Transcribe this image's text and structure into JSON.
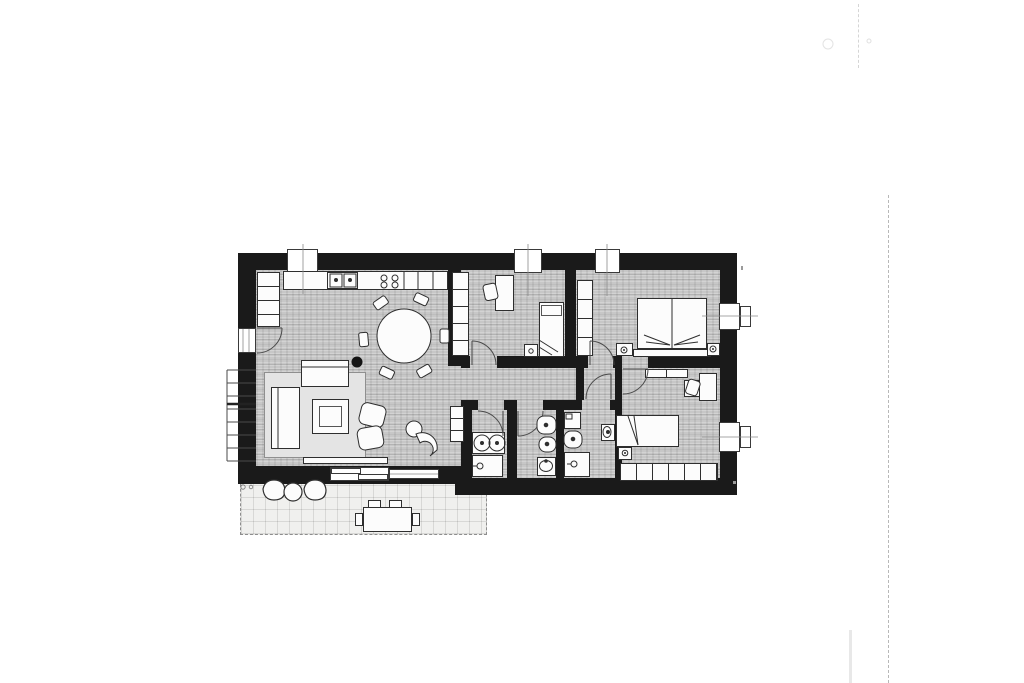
{
  "document": {
    "kind": "scanned-apartment-floor-plan",
    "visible_text": "none",
    "paper_color": "#ffffff"
  },
  "palette": {
    "wall": "#1a1a1a",
    "floor": "#c7c7c7",
    "furniture_fill": "#fcfcfc",
    "line": "#2e2e2e",
    "terrace": "#f0f0ee",
    "rug": "#e4e4e4",
    "scan_artifact": "#b8b8b8"
  },
  "apartment": {
    "rooms": [
      {
        "name": "kitchen-living-room",
        "furniture": [
          "tall-cabinet-column",
          "kitchen-counter",
          "double-sink",
          "cooktop-4-burners",
          "round-dining-table",
          "6-dining-chairs",
          "rug",
          "sofa",
          "corner-sofa",
          "coffee-table",
          "2-armchairs",
          "lounge-chair",
          "side-stool",
          "low-sideboard",
          "column-dot"
        ]
      },
      {
        "name": "bedroom-1",
        "furniture": [
          "wardrobe-5-doors",
          "desk",
          "desk-chair",
          "single-bed",
          "nightstand-with-lamp"
        ]
      },
      {
        "name": "bedroom-2",
        "furniture": [
          "wardrobe-4-doors",
          "double-bed",
          "headboard",
          "nightstand-left-with-lamp",
          "nightstand-right-with-lamp"
        ]
      },
      {
        "name": "bedroom-3",
        "furniture": [
          "wall-shelf",
          "cabinet",
          "desk",
          "desk-chair",
          "single-bed",
          "nightstand-with-lamp",
          "wardrobe-6-doors"
        ]
      },
      {
        "name": "bathroom-1",
        "furniture": [
          "double-washbasin-vanity",
          "shower"
        ]
      },
      {
        "name": "bathroom-2",
        "furniture": [
          "toilet",
          "bidet",
          "washbasin"
        ]
      },
      {
        "name": "bathroom-3",
        "furniture": [
          "washing-machine",
          "toilet",
          "shower",
          "washbasin"
        ]
      },
      {
        "name": "hallway",
        "furniture": [
          "shelf-unit"
        ]
      },
      {
        "name": "terrace",
        "furniture": [
          "2-lounge-chairs",
          "round-side-table",
          "outdoor-dining-table",
          "4-outdoor-chairs"
        ]
      },
      {
        "name": "external-staircase",
        "steps": 8
      }
    ],
    "openings": {
      "windows_top_wall": 3,
      "windows_right_wall": 2,
      "terrace_doors": 2,
      "entrance_door": 1,
      "interior_doors": 6
    }
  },
  "scan_artifacts": [
    "vertical-dashed-line-right-margin",
    "short-dashed-line-top-right",
    "faint-circle-top-right",
    "tiny-corner-marks",
    "small-o-marks-terrace"
  ]
}
